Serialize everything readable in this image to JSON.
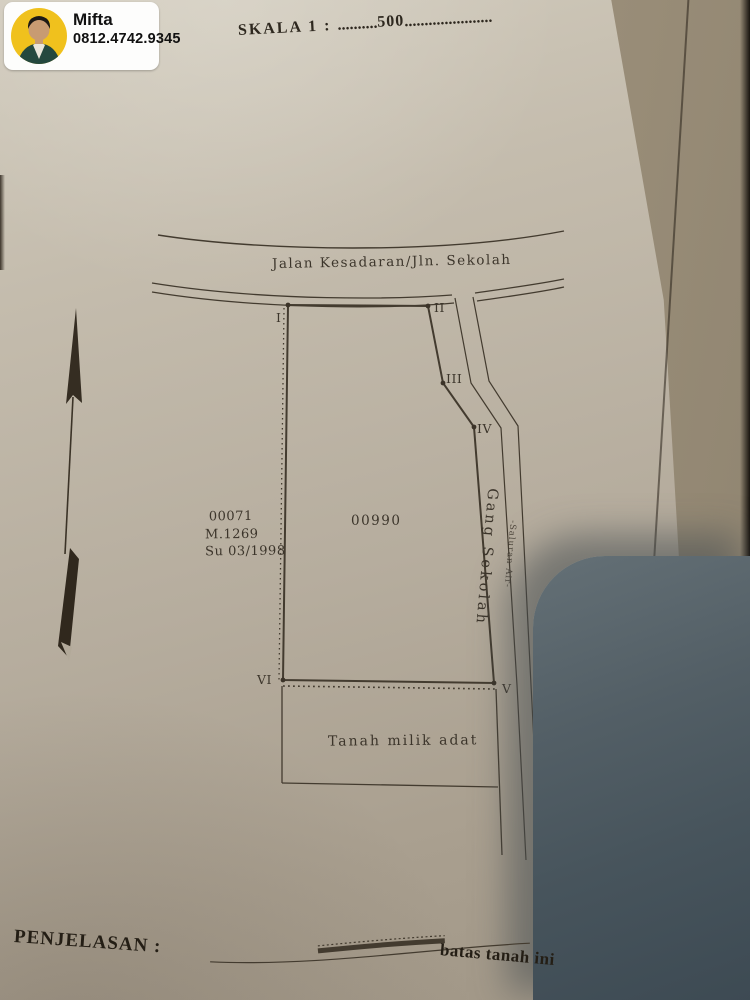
{
  "contact_card": {
    "name": "Mifta",
    "phone": "0812.4742.9345"
  },
  "scale": {
    "label": "SKALA 1 :",
    "dots_left": "..........",
    "value": "500",
    "dots_right": "......................"
  },
  "map": {
    "road_label": "Jalan Kesadaran/Jln. Sekolah",
    "corner_markers": [
      "I",
      "II",
      "III",
      "IV",
      "V",
      "VI"
    ],
    "adjacent_parcel": {
      "id": "00071",
      "m_number": "M.1269",
      "su_number": "Su 03/1998"
    },
    "parcel_id": "00990",
    "alley_label": "Gang Sekolah",
    "channel_label": "-Saluran Air-",
    "south_area_label": "Tanah milik adat",
    "north_arrow": "north-arrow"
  },
  "legend": {
    "title": "PENJELASAN :",
    "boundary_item_label": "batas tanah ini"
  },
  "colors": {
    "paper": "#bdb5a6",
    "ink": "#433b2f",
    "badge_background": "#fdfdfc",
    "avatar_background": "#f0c11d",
    "shadow_object": "#4b5860"
  }
}
